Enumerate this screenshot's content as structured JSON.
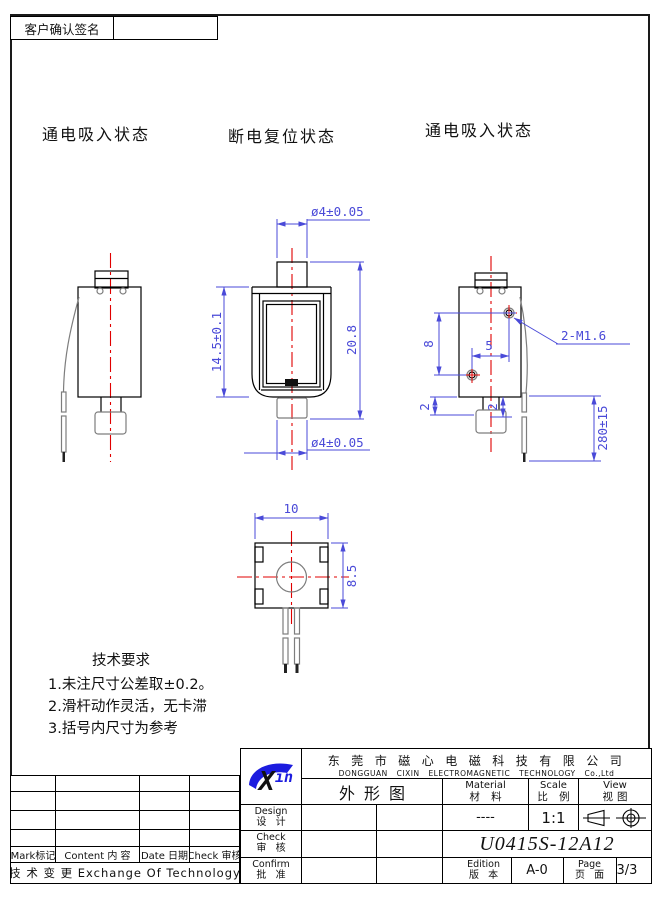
{
  "frame": {
    "signature_label": "客户确认签名"
  },
  "view_labels": {
    "left": "通电吸入状态",
    "middle": "断电复位状态",
    "right": "通电吸入状态"
  },
  "dims": {
    "top_dia": "ø4±0.05",
    "frame_height": "14.5±0.1",
    "total_height": "20.8",
    "bottom_dia": "ø4±0.05",
    "hole_spacing_v": "8",
    "hole_spacing_h": "5",
    "thread": "2-M1.6",
    "offset_left": "2",
    "offset_right": "2",
    "lead_length": "280±15",
    "top_width": "10",
    "top_depth": "8.5"
  },
  "tech": {
    "title": "技术要求",
    "items": [
      "1.未注尺寸公差取±0.2。",
      "2.滑杆动作灵活，无卡滞",
      "3.括号内尺寸为参考"
    ]
  },
  "revision": {
    "headers": [
      "Mark标记",
      "Content 内 容",
      "Date 日期",
      "Check 审核"
    ],
    "footer": "技 术 变 更  Exchange Of Technology"
  },
  "title_block": {
    "logo_x": "X",
    "logo_in": "in",
    "company_cn": "东莞市磁心电磁科技有限公司",
    "company_en": "DONGGUAN CIXIN ELECTROMAGNETIC TECHNOLOGY Co.,Ltd",
    "drawing_title": "外形图",
    "material_en": "Material",
    "material_cn": "材 料",
    "material_value": "----",
    "scale_en": "Scale",
    "scale_cn": "比 例",
    "scale_value": "1:1",
    "view_en": "View",
    "view_cn": "视图",
    "design_en": "Design",
    "design_cn": "设 计",
    "check_en": "Check",
    "check_cn": "审 核",
    "confirm_en": "Confirm",
    "confirm_cn": "批 准",
    "model": "U0415S-12A12",
    "edition_en": "Edition",
    "edition_cn": "版 本",
    "edition_value": "A-0",
    "page_en": "Page",
    "page_cn": "页 面",
    "page_value": "3/3"
  },
  "colors": {
    "dimension_blue": "#4a4ad8",
    "centerline_red": "#e00000",
    "outline_black": "#000000",
    "logo_blue": "#1c1cdf"
  }
}
